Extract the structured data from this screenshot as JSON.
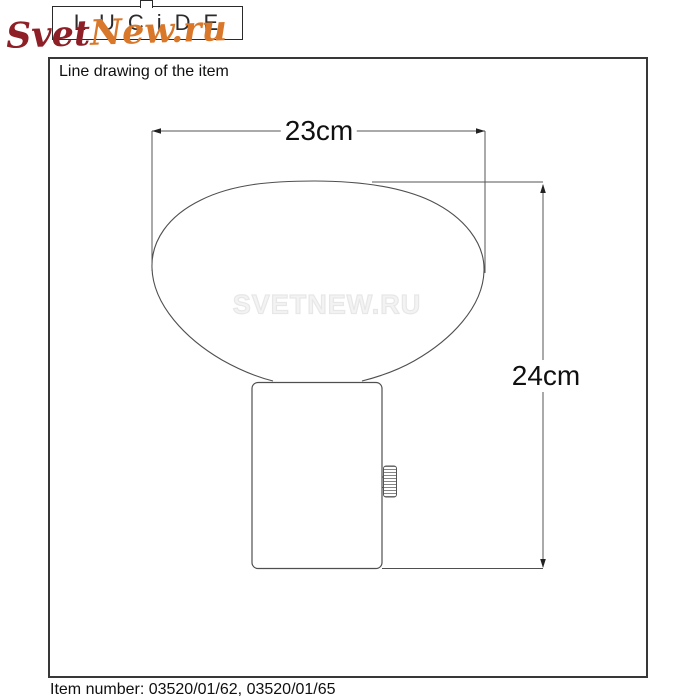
{
  "brand": {
    "lucide_logo": "LUCiDE",
    "shop_watermark_script": {
      "part1": "Svet",
      "part2": "New.ru",
      "color1": "#8e1f26",
      "color2": "#d9782a"
    },
    "center_watermark": "SVETNEW.RU"
  },
  "panel": {
    "header": "Line drawing of the item",
    "footer": "Item number: 03520/01/62, 03520/01/65"
  },
  "drawing": {
    "subject": "table lamp with oval glass shade and cylindrical base with side thumbwheel switch",
    "width_dimension": "23cm",
    "height_dimension": "24cm"
  },
  "colors": {
    "line": "#4f4f4f",
    "dimension_line": "#555555",
    "panel_border": "#383838",
    "dim_text": "#101010"
  }
}
